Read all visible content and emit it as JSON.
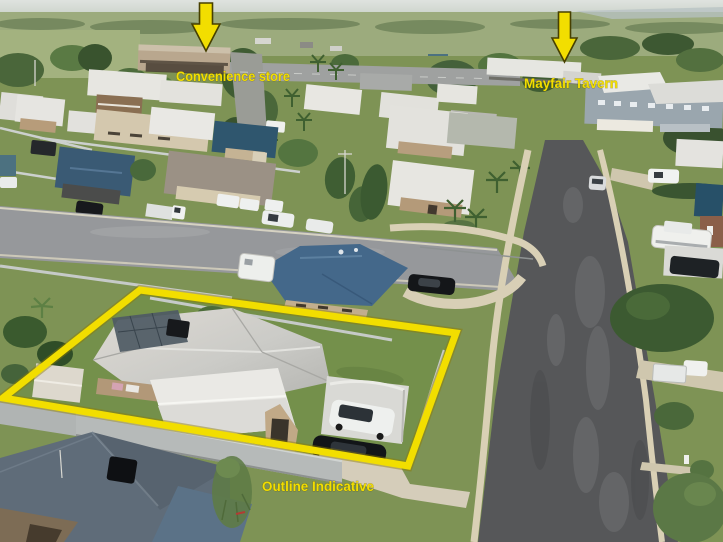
{
  "annotations": {
    "accent_color": "#F2DE00",
    "labels": {
      "store": "Convenience store",
      "tavern": "Mayfair Tavern",
      "outline": "Outline Indicative"
    }
  },
  "scene_colors": {
    "asphalt_main_road": "#565759",
    "asphalt_side_street": "#96989B",
    "sidewalk_concrete": "#D8CFB5",
    "lawn_green": "#7E9355",
    "subject_roof_gray": "#CBCBC7",
    "neighbor_roof_blue": "#44688A",
    "bottom_roof_slate": "#5F6C79",
    "sky_haze": "#D7DCD8"
  }
}
